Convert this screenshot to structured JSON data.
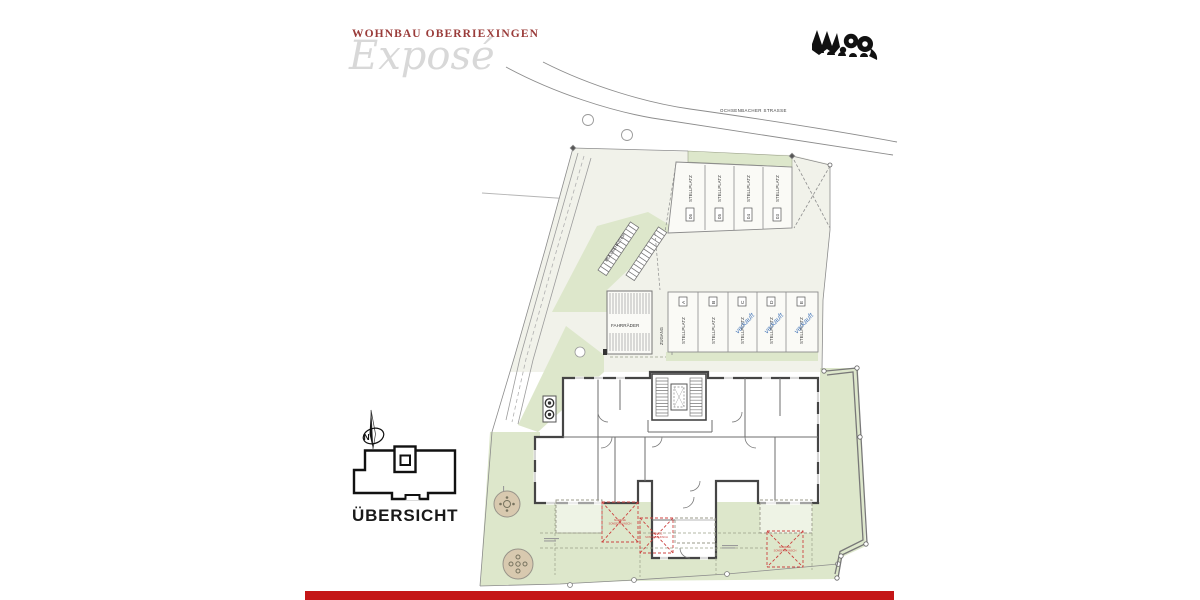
{
  "header": {
    "title": "WOHNBAU OBERRIEXINGEN",
    "subtitle": "Exposé"
  },
  "plan": {
    "street": "OCHSENBACHER STRASSE",
    "waste_label": "MÜLLBEHÄLTER",
    "bike_label": "FAHRRÄDER",
    "access_label": "ZUGANG",
    "stall_word": "STELLPLATZ",
    "upper_stalls": [
      {
        "num": "06"
      },
      {
        "num": "05"
      },
      {
        "num": "04"
      },
      {
        "num": "03"
      }
    ],
    "lower_stalls": [
      {
        "letter": "A",
        "stamp": ""
      },
      {
        "letter": "B",
        "stamp": ""
      },
      {
        "letter": "C",
        "stamp": "verkauft"
      },
      {
        "letter": "D",
        "stamp": "verkauft"
      },
      {
        "letter": "E",
        "stamp": "verkauft"
      }
    ],
    "awning_note": {
      "line1": "MARKISE",
      "line2": "SONDERWUNSCH"
    },
    "compass_letter": "N",
    "overview_label": "ÜBERSICHT"
  },
  "colors": {
    "accent_red": "#c41617",
    "title_red": "#9a3c3a",
    "lawn_green": "#dde7cb",
    "sold_blue": "#4d7cbb"
  }
}
